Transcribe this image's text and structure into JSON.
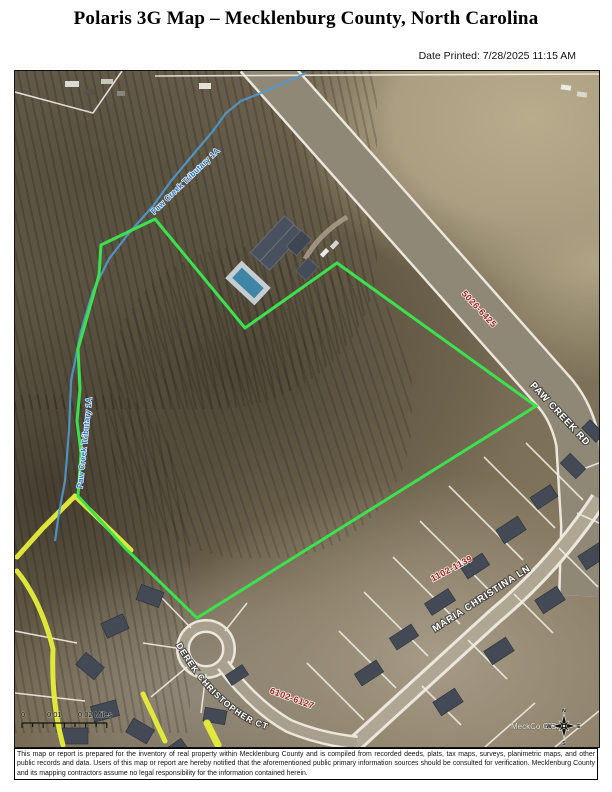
{
  "page": {
    "title": "Polaris 3G Map – Mecklenburg County, North Carolina",
    "date_printed": "Date Printed: 7/28/2025 11:15 AM"
  },
  "map": {
    "roads": {
      "paw_creek_rd": "PAW CREEK RD",
      "maria_christina_ln": "MARIA CHRISTINA LN",
      "derek_christopher_ct": "DEREK CHRISTOPHER CT"
    },
    "parcels": {
      "paw_creek_rd_range": "5026-6425",
      "maria_christina_range": "1102-1139",
      "derek_christopher_range": "6102-6127"
    },
    "water": {
      "creek_label": "Paw Creek Tributary 1A"
    },
    "scale_bar": {
      "t0": "0",
      "t1": "0.01",
      "t2": "0.02 Miles"
    },
    "compass": {
      "n": "N",
      "e": "E",
      "s": "S",
      "w": "W"
    },
    "attribution": "MeckCo GIS.",
    "colors": {
      "parcel_boundary": "#3ce24e",
      "creek": "#4f9ad2",
      "highlight": "#e6ef3a",
      "parcel_text": "#a5281e",
      "road_edge": "#ece7da"
    }
  },
  "footer": {
    "disclaimer": "This map or report is prepared for the inventory of real property within Mecklenburg County and is compiled from recorded deeds, plats, tax maps, surveys, planimetric maps, and other public records and data. Users of this map or report are hereby notified that the aforementioned public primary information sources should be consulted for verification. Mecklenburg County and its mapping contractors assume no legal responsibility for the information contained herein."
  }
}
